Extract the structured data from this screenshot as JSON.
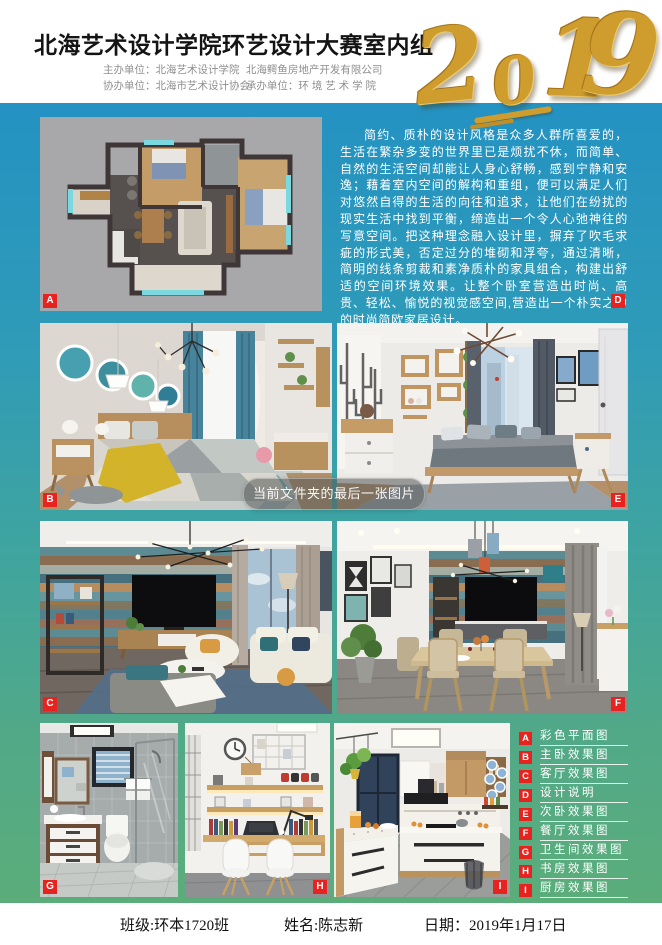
{
  "header": {
    "title": "北海艺术设计学院环艺设计大赛室内组",
    "year": {
      "d1": "2",
      "d2": "0",
      "d3": "1",
      "d4": "9"
    },
    "org_lines": [
      {
        "left": "主办单位：北海艺术设计学院",
        "right": "北海鳄鱼房地产开发有限公司"
      },
      {
        "left": "协办单位：北海市艺术设计协会",
        "right": "承办单位：环 境 艺 术 学 院"
      }
    ]
  },
  "description": "简约、质朴的设计风格是众多人群所喜爱的，生活在繁杂多变的世界里已是烦扰不休，而简单、自然的生活空间却能让人身心舒畅，感到宁静和安逸；藉着室内空间的解构和重组，便可以满足人们对悠然自得的生活的向往和追求，让他们在纷扰的现实生活中找到平衡，缔造出一个令人心弛神往的写意空间。把这种理念融入设计里，摒弃了吹毛求疵的形式美，否定过分的堆砌和浮夸，通过清晰，简明的线条剪裁和素净质朴的家具组合，构建出舒适的空间环境效果。让整个卧室营造出时尚、高贵、轻松、愉悦的视觉感空间,营造出一个朴实之中的时尚简欧家居设计。",
  "panels": {
    "floor_plan": {
      "label": "A"
    },
    "master_bedroom": {
      "label": "B"
    },
    "living_room": {
      "label": "C"
    },
    "design_notes": {
      "label": "D"
    },
    "second_bedroom": {
      "label": "E"
    },
    "dining_room": {
      "label": "F"
    },
    "bathroom": {
      "label": "G"
    },
    "study": {
      "label": "H"
    },
    "kitchen": {
      "label": "I"
    }
  },
  "legend": {
    "items": [
      {
        "key": "A",
        "label": "彩色平面图"
      },
      {
        "key": "B",
        "label": "主卧效果图"
      },
      {
        "key": "C",
        "label": "客厅效果图"
      },
      {
        "key": "D",
        "label": "设计说明"
      },
      {
        "key": "E",
        "label": "次卧效果图"
      },
      {
        "key": "F",
        "label": "餐厅效果图"
      },
      {
        "key": "G",
        "label": "卫生间效果图"
      },
      {
        "key": "H",
        "label": "书房效果图"
      },
      {
        "key": "I",
        "label": "厨房效果图"
      }
    ]
  },
  "viewer_toast": {
    "message": "当前文件夹的最后一张图片"
  },
  "footer": {
    "class": "班级:环本1720班",
    "name": "姓名:陈志新",
    "date": "日期：2019年1月17日"
  },
  "colors": {
    "board_top": "#2492c2",
    "board_bottom": "#5bad7a",
    "badge_red": "#e8231f",
    "gold": "#cf9c2e"
  }
}
